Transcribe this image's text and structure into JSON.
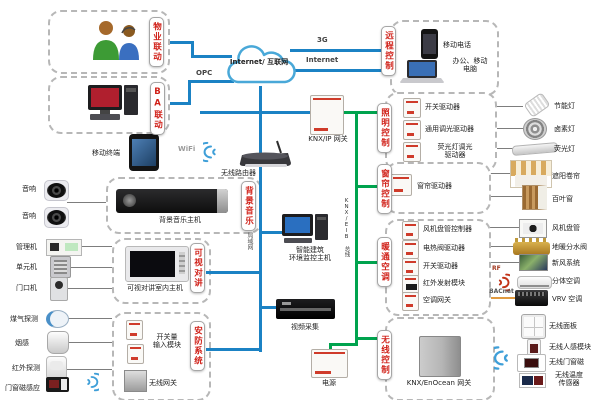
{
  "colors": {
    "blue": "#1b82c4",
    "green": "#00a34e",
    "red_tag": "#d02018",
    "orange": "#e09a40"
  },
  "cloud": {
    "label": "Internet/ 互联网"
  },
  "net": {
    "g3": "3G",
    "internet": "Internet",
    "opc": "OPC",
    "wifi": "WiFi",
    "lan": "局域网",
    "bus": "KNX/EIB 总线",
    "rf": "RF",
    "bacnet": "BACnet"
  },
  "tags": {
    "property": "物业联动",
    "ba": "BA联动",
    "remote": "远程控制",
    "lighting": "照明控制",
    "curtain": "窗帘控制",
    "hvac": "暖通空调",
    "wireless": "无线控制",
    "bgm": "背景音乐",
    "intercom": "可视对讲",
    "security": "安防系统"
  },
  "remote": {
    "phone": "移动电话",
    "laptop": "办公、移动\n电脑"
  },
  "core": {
    "knx_ip_gateway": "KNX/IP 网关",
    "router": "无线路由器",
    "tablet": "移动终端",
    "monitor_host": "智能建筑\n环境监控主机",
    "video_capture": "视频采集",
    "power": "电源",
    "enocean_gateway": "KNX/EnOcean 网关"
  },
  "bgm": {
    "host": "背景音乐主机"
  },
  "intercom": {
    "indoor_host": "可视对讲室内主机",
    "units": [
      "管理机",
      "单元机",
      "门口机"
    ]
  },
  "security": {
    "input_module": "开关量\n输入模块",
    "wireless_gateway": "无线网关",
    "sensors": [
      "煤气探测",
      "烟感",
      "红外探测",
      "门窗磁感应"
    ]
  },
  "audio": {
    "speakers": [
      "音响",
      "音响"
    ]
  },
  "lighting": {
    "drivers": [
      "开关驱动器",
      "通用调光驱动器",
      "荧光灯调光\n驱动器"
    ],
    "loads": [
      "节能灯",
      "卤素灯",
      "荧光灯"
    ]
  },
  "curtain": {
    "drivers": [
      "窗帘驱动器"
    ],
    "loads": [
      "遮阳卷帘",
      "百叶窗"
    ]
  },
  "hvac": {
    "drivers": [
      "风机盘管控制器",
      "电热阀驱动器",
      "开关驱动器",
      "红外发射模块",
      "空调网关"
    ],
    "loads": [
      "风机盘管",
      "地暖分水阀",
      "新风系统",
      "分体空调",
      "VRV 空调"
    ]
  },
  "wireless": {
    "devices": [
      "无线面板",
      "无线人感模块",
      "无线门窗磁",
      "无线温度\n传感器"
    ]
  }
}
